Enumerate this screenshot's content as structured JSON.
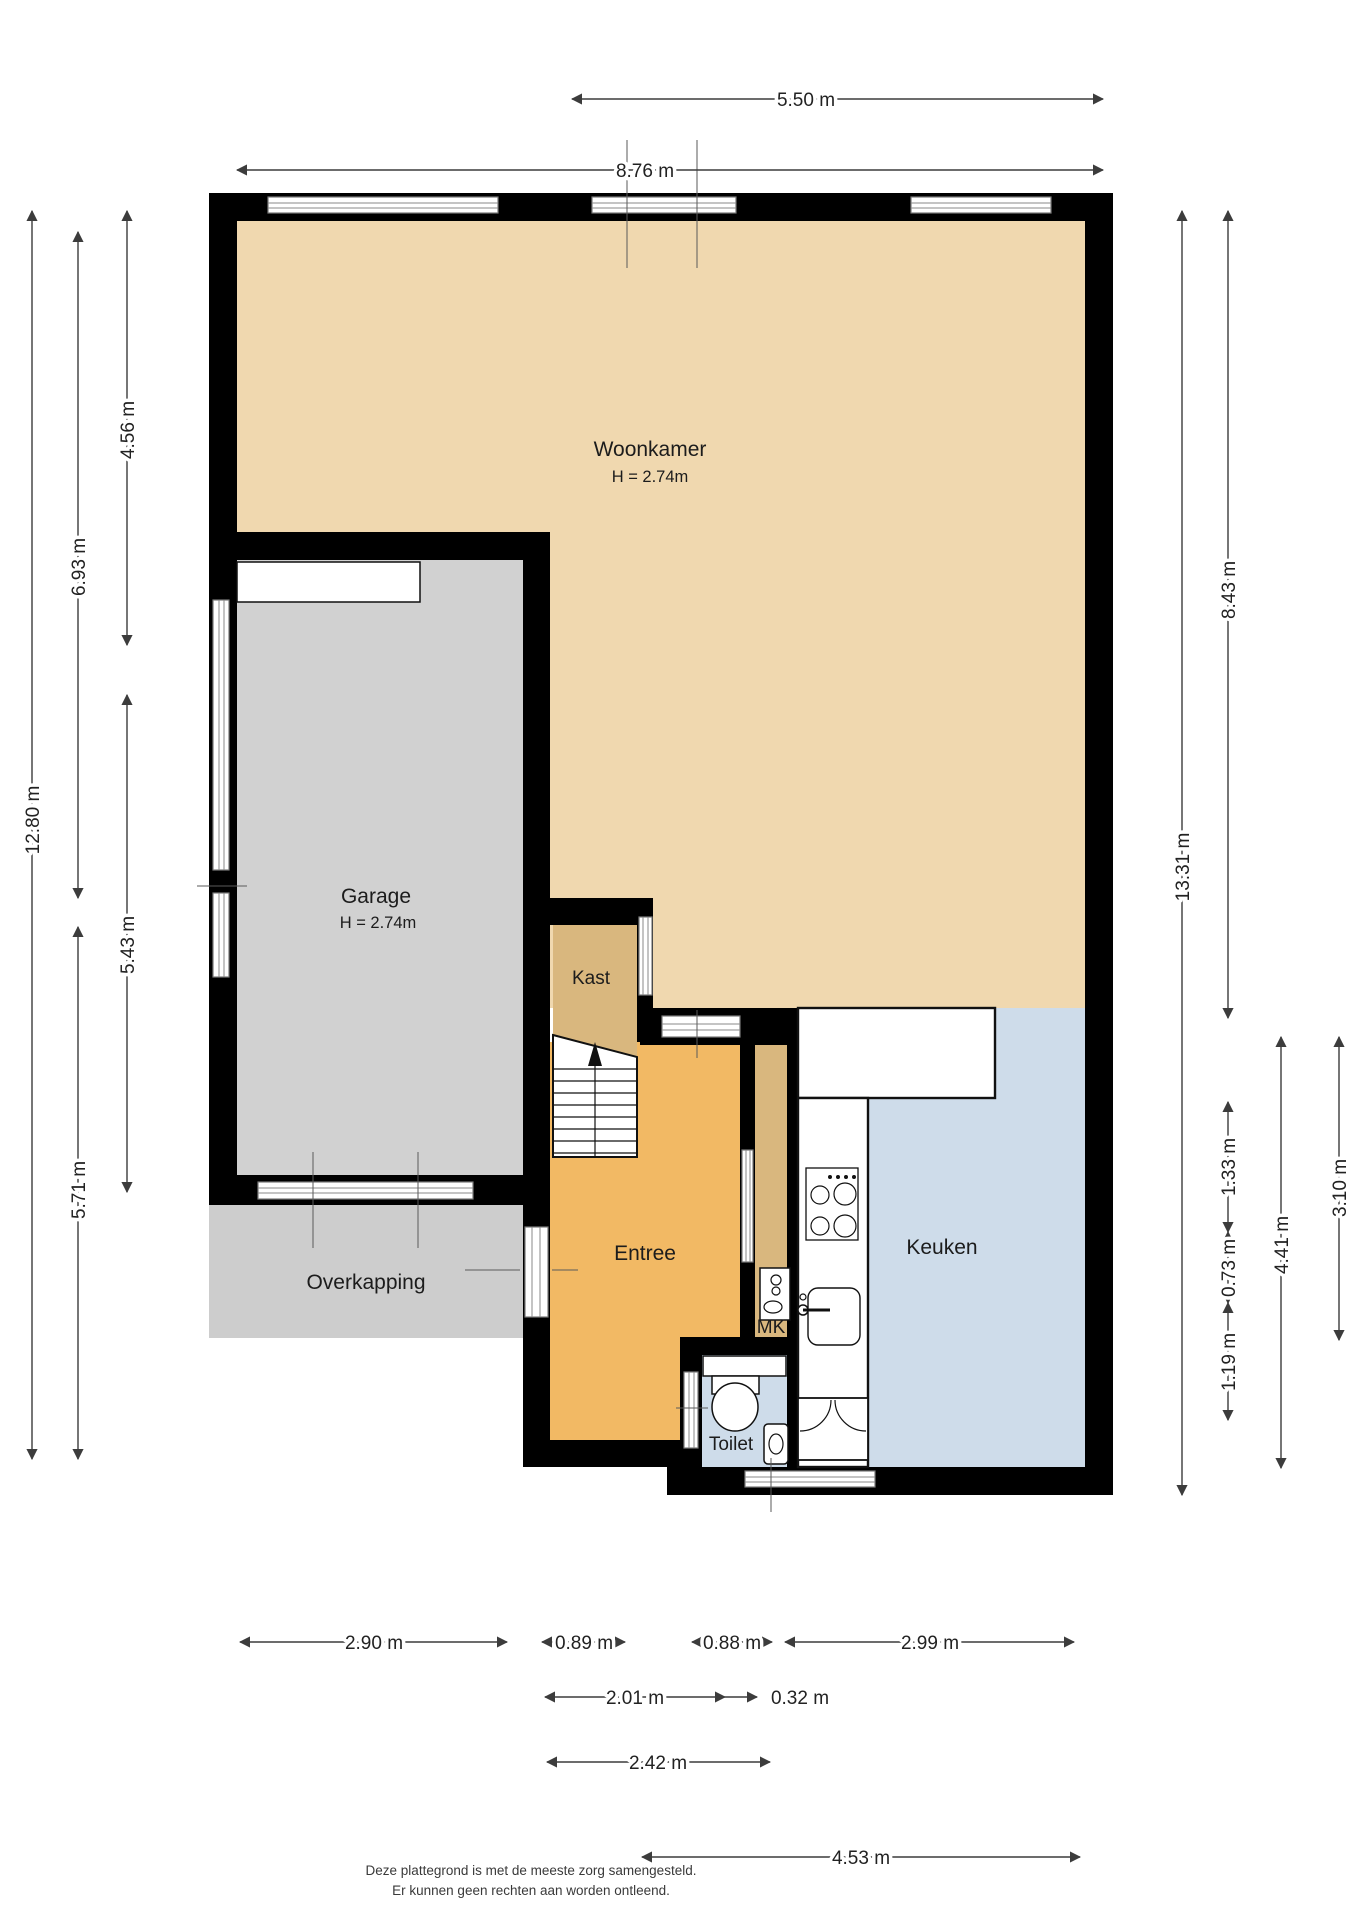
{
  "rooms": {
    "woonkamer": {
      "name": "Woonkamer",
      "height": "H = 2.74m",
      "color": "#f0d8af"
    },
    "garage": {
      "name": "Garage",
      "height": "H = 2.74m",
      "color": "#d1d1d1"
    },
    "kast": {
      "name": "Kast",
      "color": "#d9b77e"
    },
    "entree": {
      "name": "Entree",
      "color": "#f2b964"
    },
    "keuken": {
      "name": "Keuken",
      "color": "#cedcea"
    },
    "toilet": {
      "name": "Toilet",
      "color": "#cedcea"
    },
    "mk": {
      "name": "MK",
      "color": "#d9b77e"
    },
    "overkapping": {
      "name": "Overkapping",
      "color": "#cdcdcd"
    }
  },
  "colors": {
    "wall": "#000000",
    "dimension_line": "#3c3c3c",
    "background": "#ffffff"
  },
  "dimensions": {
    "top": [
      "5.50 m",
      "8.76 m"
    ],
    "left": [
      "4.56 m",
      "6.93 m",
      "12.80 m",
      "5.43 m",
      "5.71 m"
    ],
    "right": [
      "8.43 m",
      "13.31 m",
      "1.33 m",
      "0.73 m",
      "1.19 m",
      "4.41 m",
      "3.10 m"
    ],
    "bottom": [
      "2.90 m",
      "0.89 m",
      "0.88 m",
      "2.99 m",
      "2.01 m",
      "0.32 m",
      "2.42 m",
      "4.53 m"
    ]
  },
  "footer": {
    "line1": "Deze plattegrond is met de meeste zorg samengesteld.",
    "line2": "Er kunnen geen rechten aan worden ontleend."
  }
}
